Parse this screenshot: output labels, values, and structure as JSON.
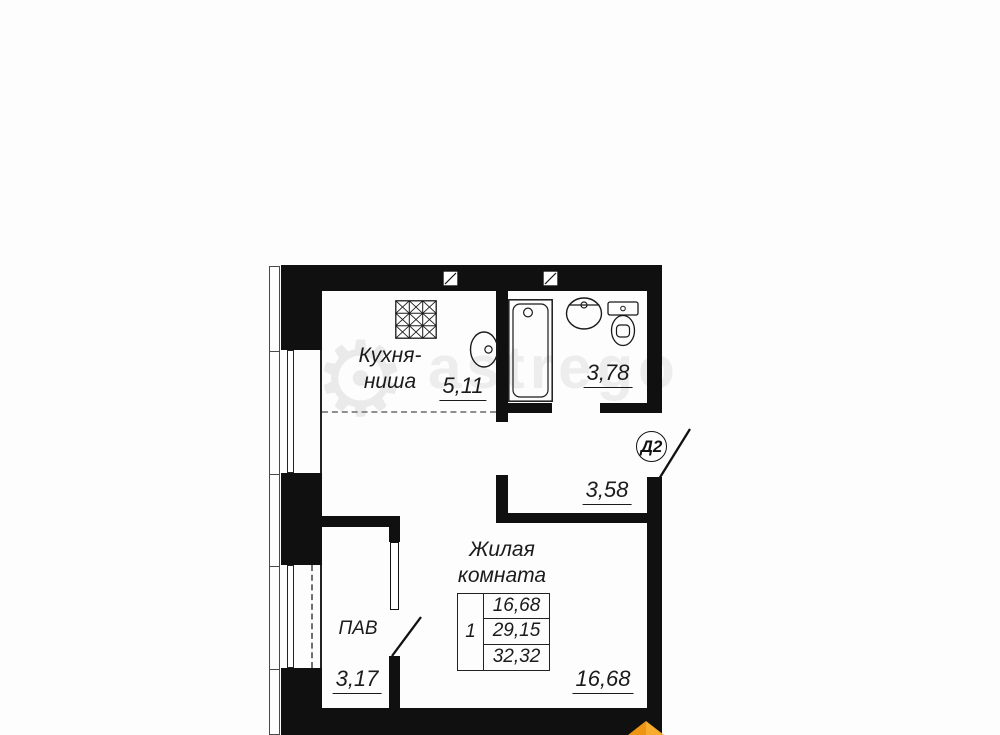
{
  "unit": {
    "label": "Д2"
  },
  "rooms": {
    "kitchen": {
      "name_line1": "Кухня-",
      "name_line2": "ниша",
      "area": "5,11"
    },
    "bathroom": {
      "area": "3,78"
    },
    "hall": {
      "area": "3,58"
    },
    "living": {
      "name_line1": "Жилая",
      "name_line2": "комната",
      "area": "16,68"
    },
    "pantry": {
      "name": "ПАВ",
      "area": "3,17"
    }
  },
  "area_table": {
    "rooms_count": "1",
    "living_area": "16,68",
    "total_area": "29,15",
    "total_with_balcony": "32,32"
  },
  "watermark": {
    "text": "astrego",
    "gear_glyph": "⚙"
  },
  "icons": {
    "stove": "stove-icon",
    "kitchen_sink": "kitchen-sink-icon",
    "bathtub": "bathtub-icon",
    "washbasin": "washbasin-icon",
    "toilet": "toilet-icon",
    "vent": "vent-icon",
    "door_leaf": "door-leaf-icon",
    "gear": "gear-watermark-icon",
    "brand_logo": "brand-logo-icon"
  },
  "colors": {
    "wall": "#101010",
    "line": "#1b1b1b",
    "watermark": "#ededed",
    "logo_orange": "#F59E1E"
  }
}
